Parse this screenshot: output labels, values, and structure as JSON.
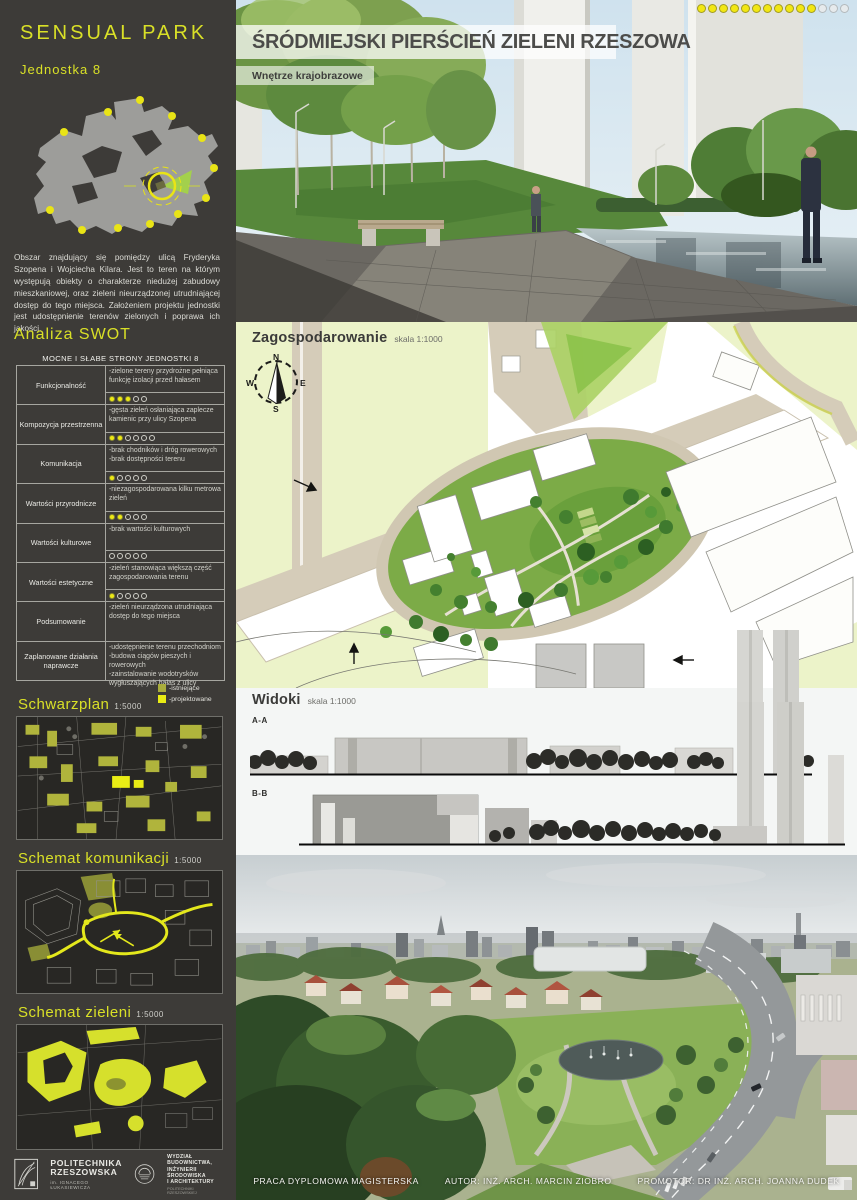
{
  "sidebar": {
    "title": "SENSUAL PARK",
    "subtitle": "Jednostka 8",
    "description": "Obszar znajdujący się pomiędzy ulicą Fryderyka Szopena i Wojciecha Kilara. Jest to teren na którym występują obiekty o charakterze niedużej zabudowy mieszkaniowej, oraz zieleni nieurządzonej utrudniającej dostęp do tego miejsca. Założeniem projektu jednostki jest udostępnienie terenów zielonych i poprawa ich jakości.",
    "swot": {
      "heading": "Analiza SWOT",
      "table_title": "MOCNE I SŁABE STRONY JEDNOSTKI 8",
      "rows": [
        {
          "label": "Funkcjonalność",
          "text": "-zielone tereny przydrożne pełniąca funkcję izolacji przed hałasem",
          "rating": {
            "filled": 3,
            "total": 5
          }
        },
        {
          "label": "Kompozycja przestrzenna",
          "text": "-gęsta zieleń osłaniająca zaplecze kamienic przy ulicy Szopena",
          "rating": {
            "filled": 2,
            "total": 6
          }
        },
        {
          "label": "Komunikacja",
          "text": "-brak chodników i dróg rowerowych\n-brak dostępności terenu",
          "rating": {
            "filled": 1,
            "total": 5
          }
        },
        {
          "label": "Wartości przyrodnicze",
          "text": "-niezagospodarowana kilku metrowa zieleń",
          "rating": {
            "filled": 2,
            "total": 5
          }
        },
        {
          "label": "Wartości kulturowe",
          "text": "-brak wartości kulturowych",
          "rating": {
            "filled": 0,
            "total": 5
          }
        },
        {
          "label": "Wartości estetyczne",
          "text": "-zieleń stanowiąca większą część zagospodarowania terenu",
          "rating": {
            "filled": 1,
            "total": 5
          }
        },
        {
          "label": "Podsumowanie",
          "text": "-zieleń nieurządzona utrudniająca dostęp do tego miejsca",
          "rating": null
        },
        {
          "label": "Zaplanowane działania naprawcze",
          "text": "-udostępnienie terenu przechodniom\n-budowa ciągów pieszych i rowerowych\n-zainstalowanie wodotrysków wygłuszających hałas z ulicy",
          "rating": null
        }
      ]
    },
    "legend": {
      "items": [
        {
          "label": "-istniejące",
          "color": "#a9ad3c"
        },
        {
          "label": "-projektowane",
          "color": "#e9ec14"
        }
      ]
    },
    "maps": [
      {
        "title": "Schwarzplan",
        "scale": "1:5000"
      },
      {
        "title": "Schemat komunikacji",
        "scale": "1:5000"
      },
      {
        "title": "Schemat zieleni",
        "scale": "1:5000"
      }
    ],
    "logos": {
      "university": {
        "line1": "POLITECHNIKA",
        "line2": "RZESZOWSKA",
        "line3": "im. IGNACEGO ŁUKASIEWICZA"
      },
      "faculty": {
        "line1": "WYDZIAŁ",
        "line2": "BUDOWNICTWA,",
        "line3": "INŻYNIERII ŚRODOWISKA",
        "line4": "I ARCHITEKTURY",
        "line5": "POLITECHNIKI RZESZOWSKIEJ"
      }
    }
  },
  "main": {
    "title": "ŚRÓDMIEJSKI PIERŚCIEŃ ZIELENI RZESZOWA",
    "subtitle": "Wnętrze krajobrazowe",
    "progress_dots": {
      "filled": 11,
      "total": 14,
      "filled_color": "#f2e713",
      "empty_color": "#e6eaec"
    },
    "plan": {
      "title": "Zagospodarowanie",
      "scale": "skala 1:1000",
      "compass": {
        "n": "N",
        "e": "E",
        "s": "S",
        "w": "W"
      }
    },
    "views": {
      "title": "Widoki",
      "scale": "skala 1:1000",
      "section_a": "A-A",
      "section_b": "B-B"
    },
    "footer": {
      "work_type": "PRACA DYPLOMOWA MAGISTERSKA",
      "author": "AUTOR: INŻ. ARCH. MARCIN ZIOBRO",
      "promoter": "PROMOTOR: DR INŻ. ARCH. JOANNA DUDEK"
    }
  }
}
